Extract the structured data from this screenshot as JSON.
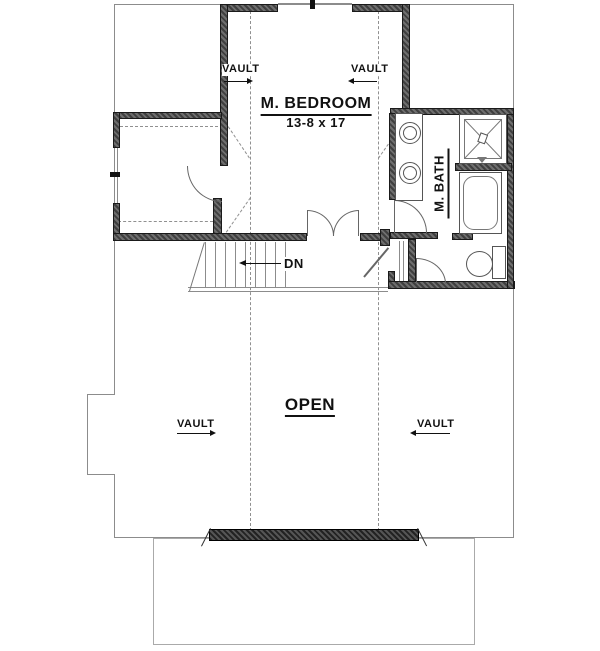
{
  "plan": {
    "type": "architectural-floor-plan",
    "labels": {
      "bedroom_name": "M. BEDROOM",
      "bedroom_dim": "13-8 x 17",
      "bath_name": "M. BATH",
      "open": "OPEN",
      "down": "DN",
      "vault": "VAULT"
    },
    "rooms": [
      "M. BEDROOM",
      "M. BATH",
      "OPEN"
    ],
    "fixtures": [
      "double-vanity-sinks",
      "shower",
      "bathtub",
      "toilet",
      "stairs-down",
      "double-door",
      "closet"
    ],
    "colors": {
      "wall_dark": "#3f3f3f",
      "wall_light": "#6e6e6e",
      "thin_line": "#8c8c8c",
      "text": "#111111",
      "background": "#ffffff"
    }
  }
}
